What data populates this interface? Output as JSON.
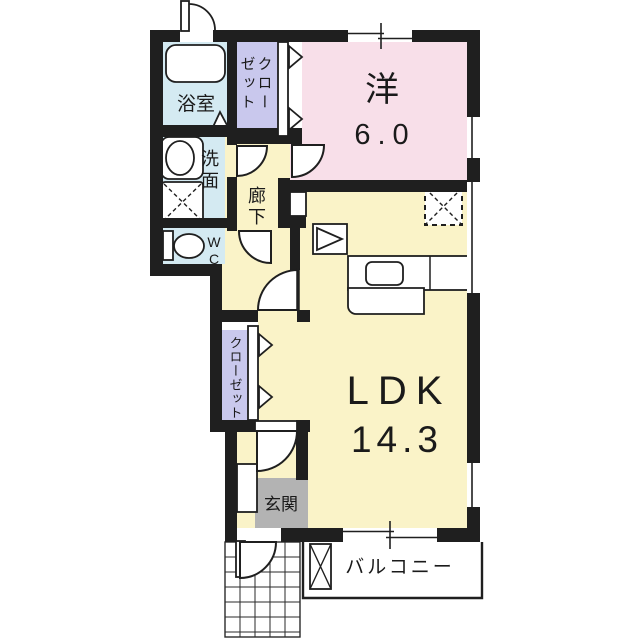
{
  "floorplan": {
    "labels": {
      "western": "洋",
      "western_size": "6.0",
      "ldk": "LDK",
      "ldk_size": "14.3",
      "bathroom": "浴室",
      "washroom": "洗面",
      "wc": "WC",
      "hallway": "廊下",
      "closet_upper_col1": "クロー",
      "closet_upper_col2": "ゼット",
      "closet_lower": "クローゼット",
      "entrance": "玄関",
      "balcony": "バルコニー"
    },
    "rooms": [
      {
        "name": "洋室",
        "size_tatami": "6.0"
      },
      {
        "name": "LDK",
        "size_tatami": "14.3"
      },
      {
        "name": "浴室"
      },
      {
        "name": "洗面"
      },
      {
        "name": "WC"
      },
      {
        "name": "廊下"
      },
      {
        "name": "クローゼット"
      },
      {
        "name": "クローゼット"
      },
      {
        "name": "玄関"
      },
      {
        "name": "バルコニー"
      }
    ],
    "colors": {
      "wall": "#1f1f1f",
      "western": "#f8dfe9",
      "ldk": "#faf3c8",
      "wet": "#d4eaf2",
      "closet": "#c9c8ed",
      "mat": "#b3b3b3"
    }
  }
}
